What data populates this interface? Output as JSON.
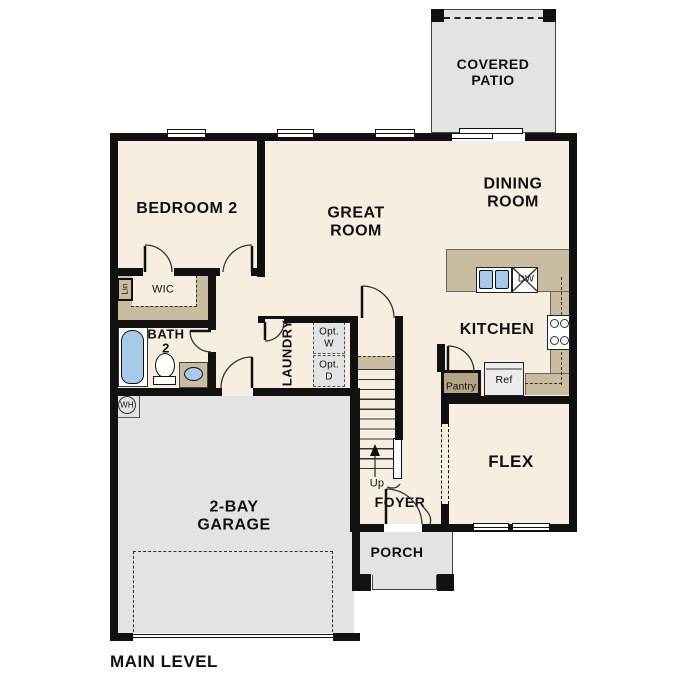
{
  "title": "MAIN LEVEL",
  "labels": {
    "main_level": "MAIN LEVEL",
    "covered_patio": "COVERED\nPATIO",
    "dining_room": "DINING\nROOM",
    "great_room": "GREAT\nROOM",
    "bedroom_2": "BEDROOM 2",
    "kitchen": "KITCHEN",
    "flex": "FLEX",
    "garage": "2-BAY\nGARAGE",
    "foyer": "FOYER",
    "porch": "PORCH",
    "bath_2": "BATH\n2",
    "wic": "WIC",
    "laundry": "LAUNDRY",
    "linen": "Lin",
    "opt_washer": "Opt.\nW",
    "opt_dryer": "Opt.\nD",
    "pantry": "Pantry",
    "refrigerator": "Ref",
    "dishwasher": "DW",
    "water_heater": "WH",
    "stairs_up": "Up"
  },
  "palette": {
    "wall": "#111111",
    "floor_cream": "#f6efe1",
    "counter_tan": "#c9bda1",
    "pantry_tan": "#b2a486",
    "concrete_gray": "#e3e3e3",
    "fixture_blue": "#a9c9e9",
    "appliance_gray": "#ececec",
    "optional_gray": "#e0e4e5",
    "outline": "#444444"
  }
}
